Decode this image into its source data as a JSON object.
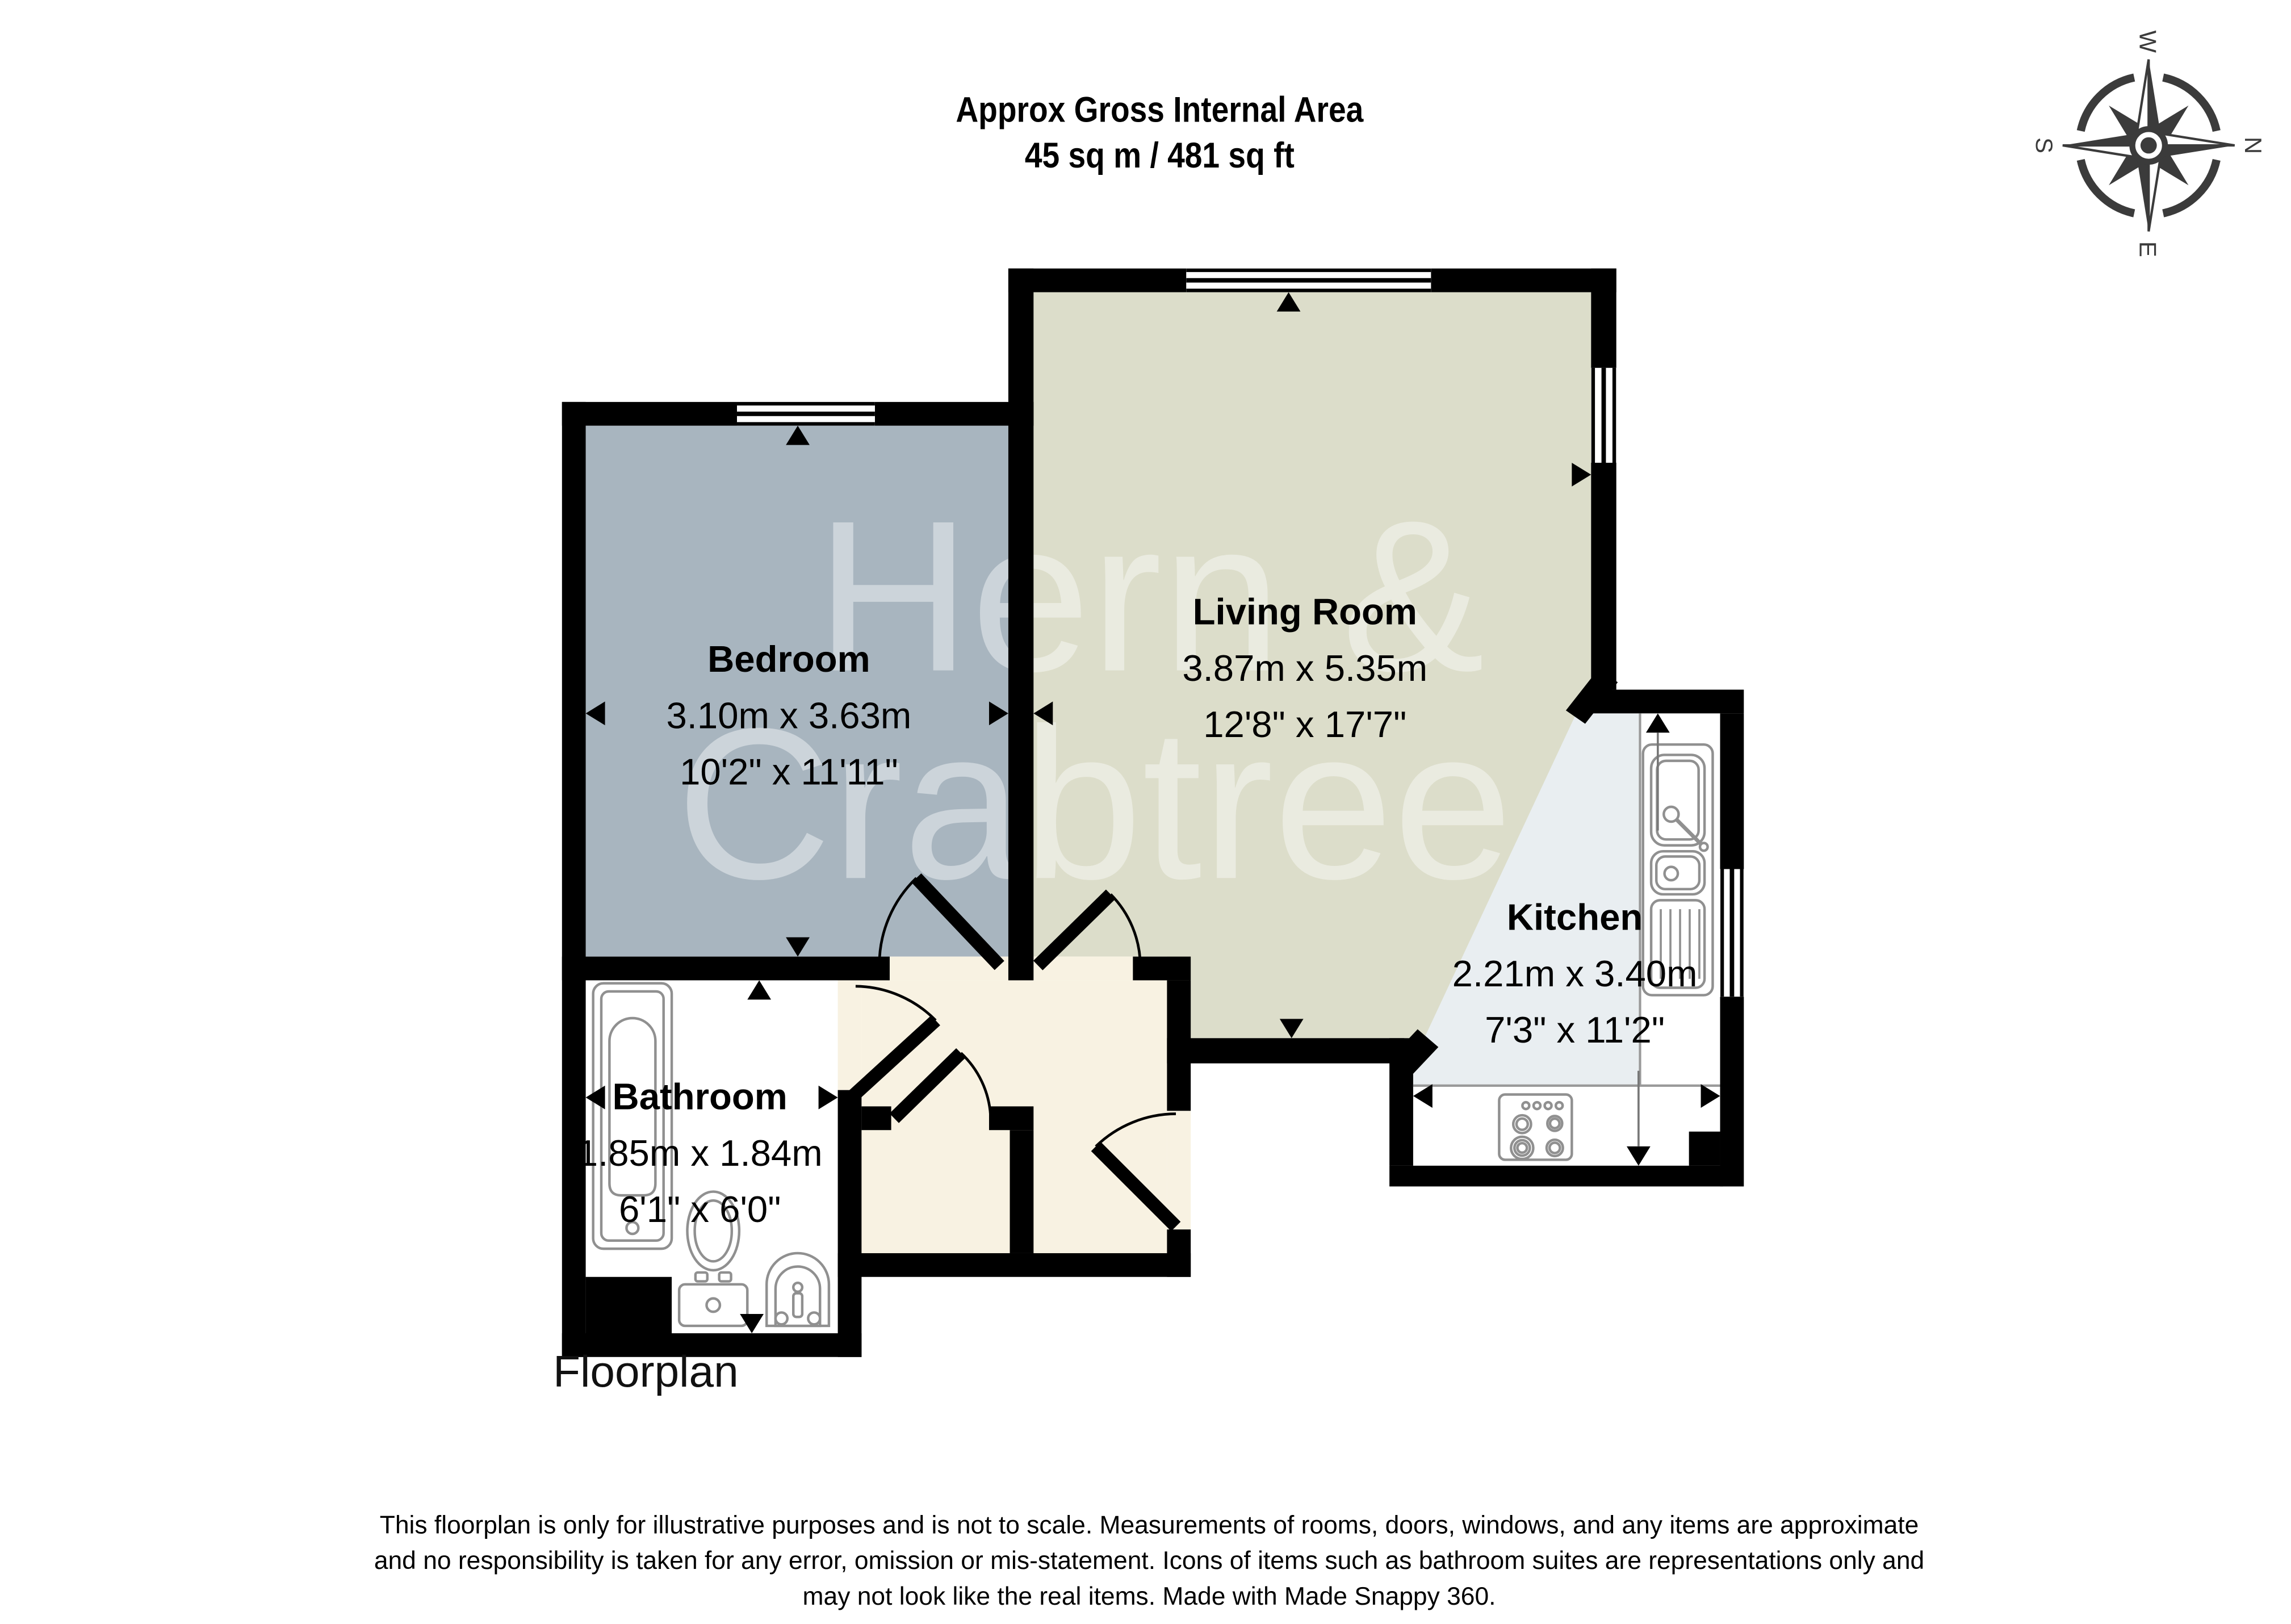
{
  "title": {
    "line1": "Approx Gross Internal Area",
    "line2": "45 sq m / 481 sq ft"
  },
  "compass": {
    "n": "N",
    "e": "E",
    "s": "S",
    "w": "W"
  },
  "watermark": {
    "line1": "Hern &",
    "line2": "Crabtree"
  },
  "rooms": [
    {
      "id": "bedroom",
      "name": "Bedroom",
      "metric": "3.10m x 3.63m",
      "imperial": "10'2\" x 11'11\""
    },
    {
      "id": "living-room",
      "name": "Living Room",
      "metric": "3.87m x 5.35m",
      "imperial": "12'8\" x 17'7\""
    },
    {
      "id": "kitchen",
      "name": "Kitchen",
      "metric": "2.21m x 3.40m",
      "imperial": "7'3\" x 11'2\""
    },
    {
      "id": "bathroom",
      "name": "Bathroom",
      "metric": "1.85m x 1.84m",
      "imperial": "6'1\" x 6'0\""
    }
  ],
  "caption": "Floorplan",
  "disclaimer": {
    "line1": "This floorplan is only for illustrative purposes and is not to scale. Measurements of rooms, doors, windows, and any items are approximate",
    "line2": "and no responsibility is taken for any error, omission or mis-statement. Icons of items such as bathroom suites are representations only and",
    "line3": "may not look like the real items. Made with Made Snappy 360."
  },
  "colors": {
    "walls": "#000000",
    "bedroom_fill": "#a8b5bf",
    "living_fill": "#dcddca",
    "kitchen_fill": "#e9eef1",
    "hall_fill": "#f8f2e2",
    "bathroom_fill": "#ffffff",
    "fixture_stroke": "#909090",
    "counter_line": "#9a9a9a",
    "dim_line": "#777777",
    "compass": "#3b3b3b",
    "watermark": "#ffffff",
    "text": "#000000"
  }
}
